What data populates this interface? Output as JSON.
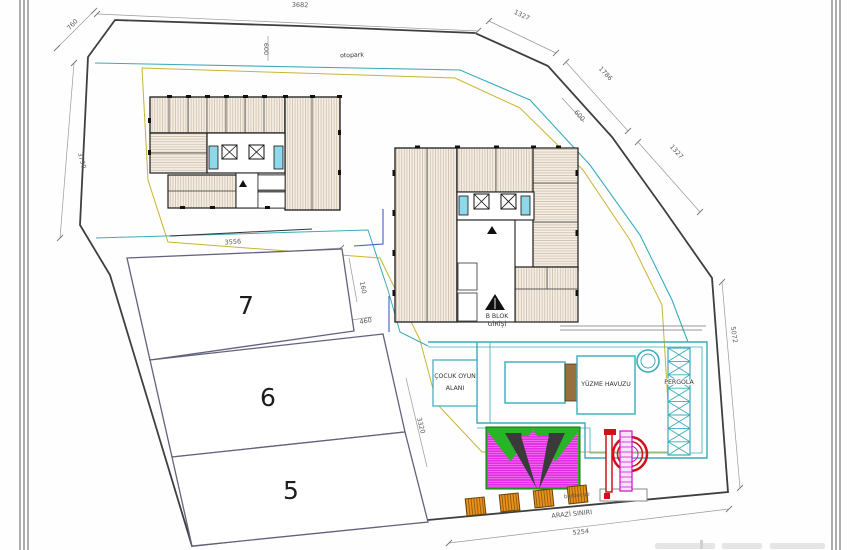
{
  "plan": {
    "labels": {
      "otopark": "otopark",
      "b_blok_1": "B BLOK",
      "b_blok_2": "GİRİŞİ",
      "play_1": "ÇOCUK OYUN",
      "play_2": "ALANI",
      "pool": "YÜZME HAVUZU",
      "pergola": "PERGOLA",
      "barbecue": "barbecue",
      "boundary": "ARAZİ SINIRI"
    },
    "parcels": [
      {
        "number": "7"
      },
      {
        "number": "6"
      },
      {
        "number": "5"
      }
    ],
    "dimensions": {
      "top": "3682",
      "top_left": "760",
      "left": "3790",
      "otopark_width": "600",
      "ne1": "1327",
      "ne2": "1786",
      "ne3": "600",
      "ne4": "1327",
      "right": "5072",
      "parcel7_top": "3556",
      "parcel7_right": "160",
      "jog": "460",
      "pool_side": "3320",
      "bottom": "5254"
    },
    "colors": {
      "boundary_line": "#3f3f3f",
      "parcel_line": "#62627c",
      "teal": "#3aacba",
      "yellow": "#c9b435",
      "blue": "#3d5fc0",
      "wall": "#1c1c1c",
      "room_fill": "#f4eee4",
      "hatch_line": "#cdbba6",
      "lift_cyan": "#8fd8ea",
      "tent_green": "#27b427",
      "tent_magenta": "#e22ce2",
      "slide_red": "#d0101c",
      "slide_magenta": "#cc10cc",
      "barbecue_orange": "#e8921e"
    }
  }
}
